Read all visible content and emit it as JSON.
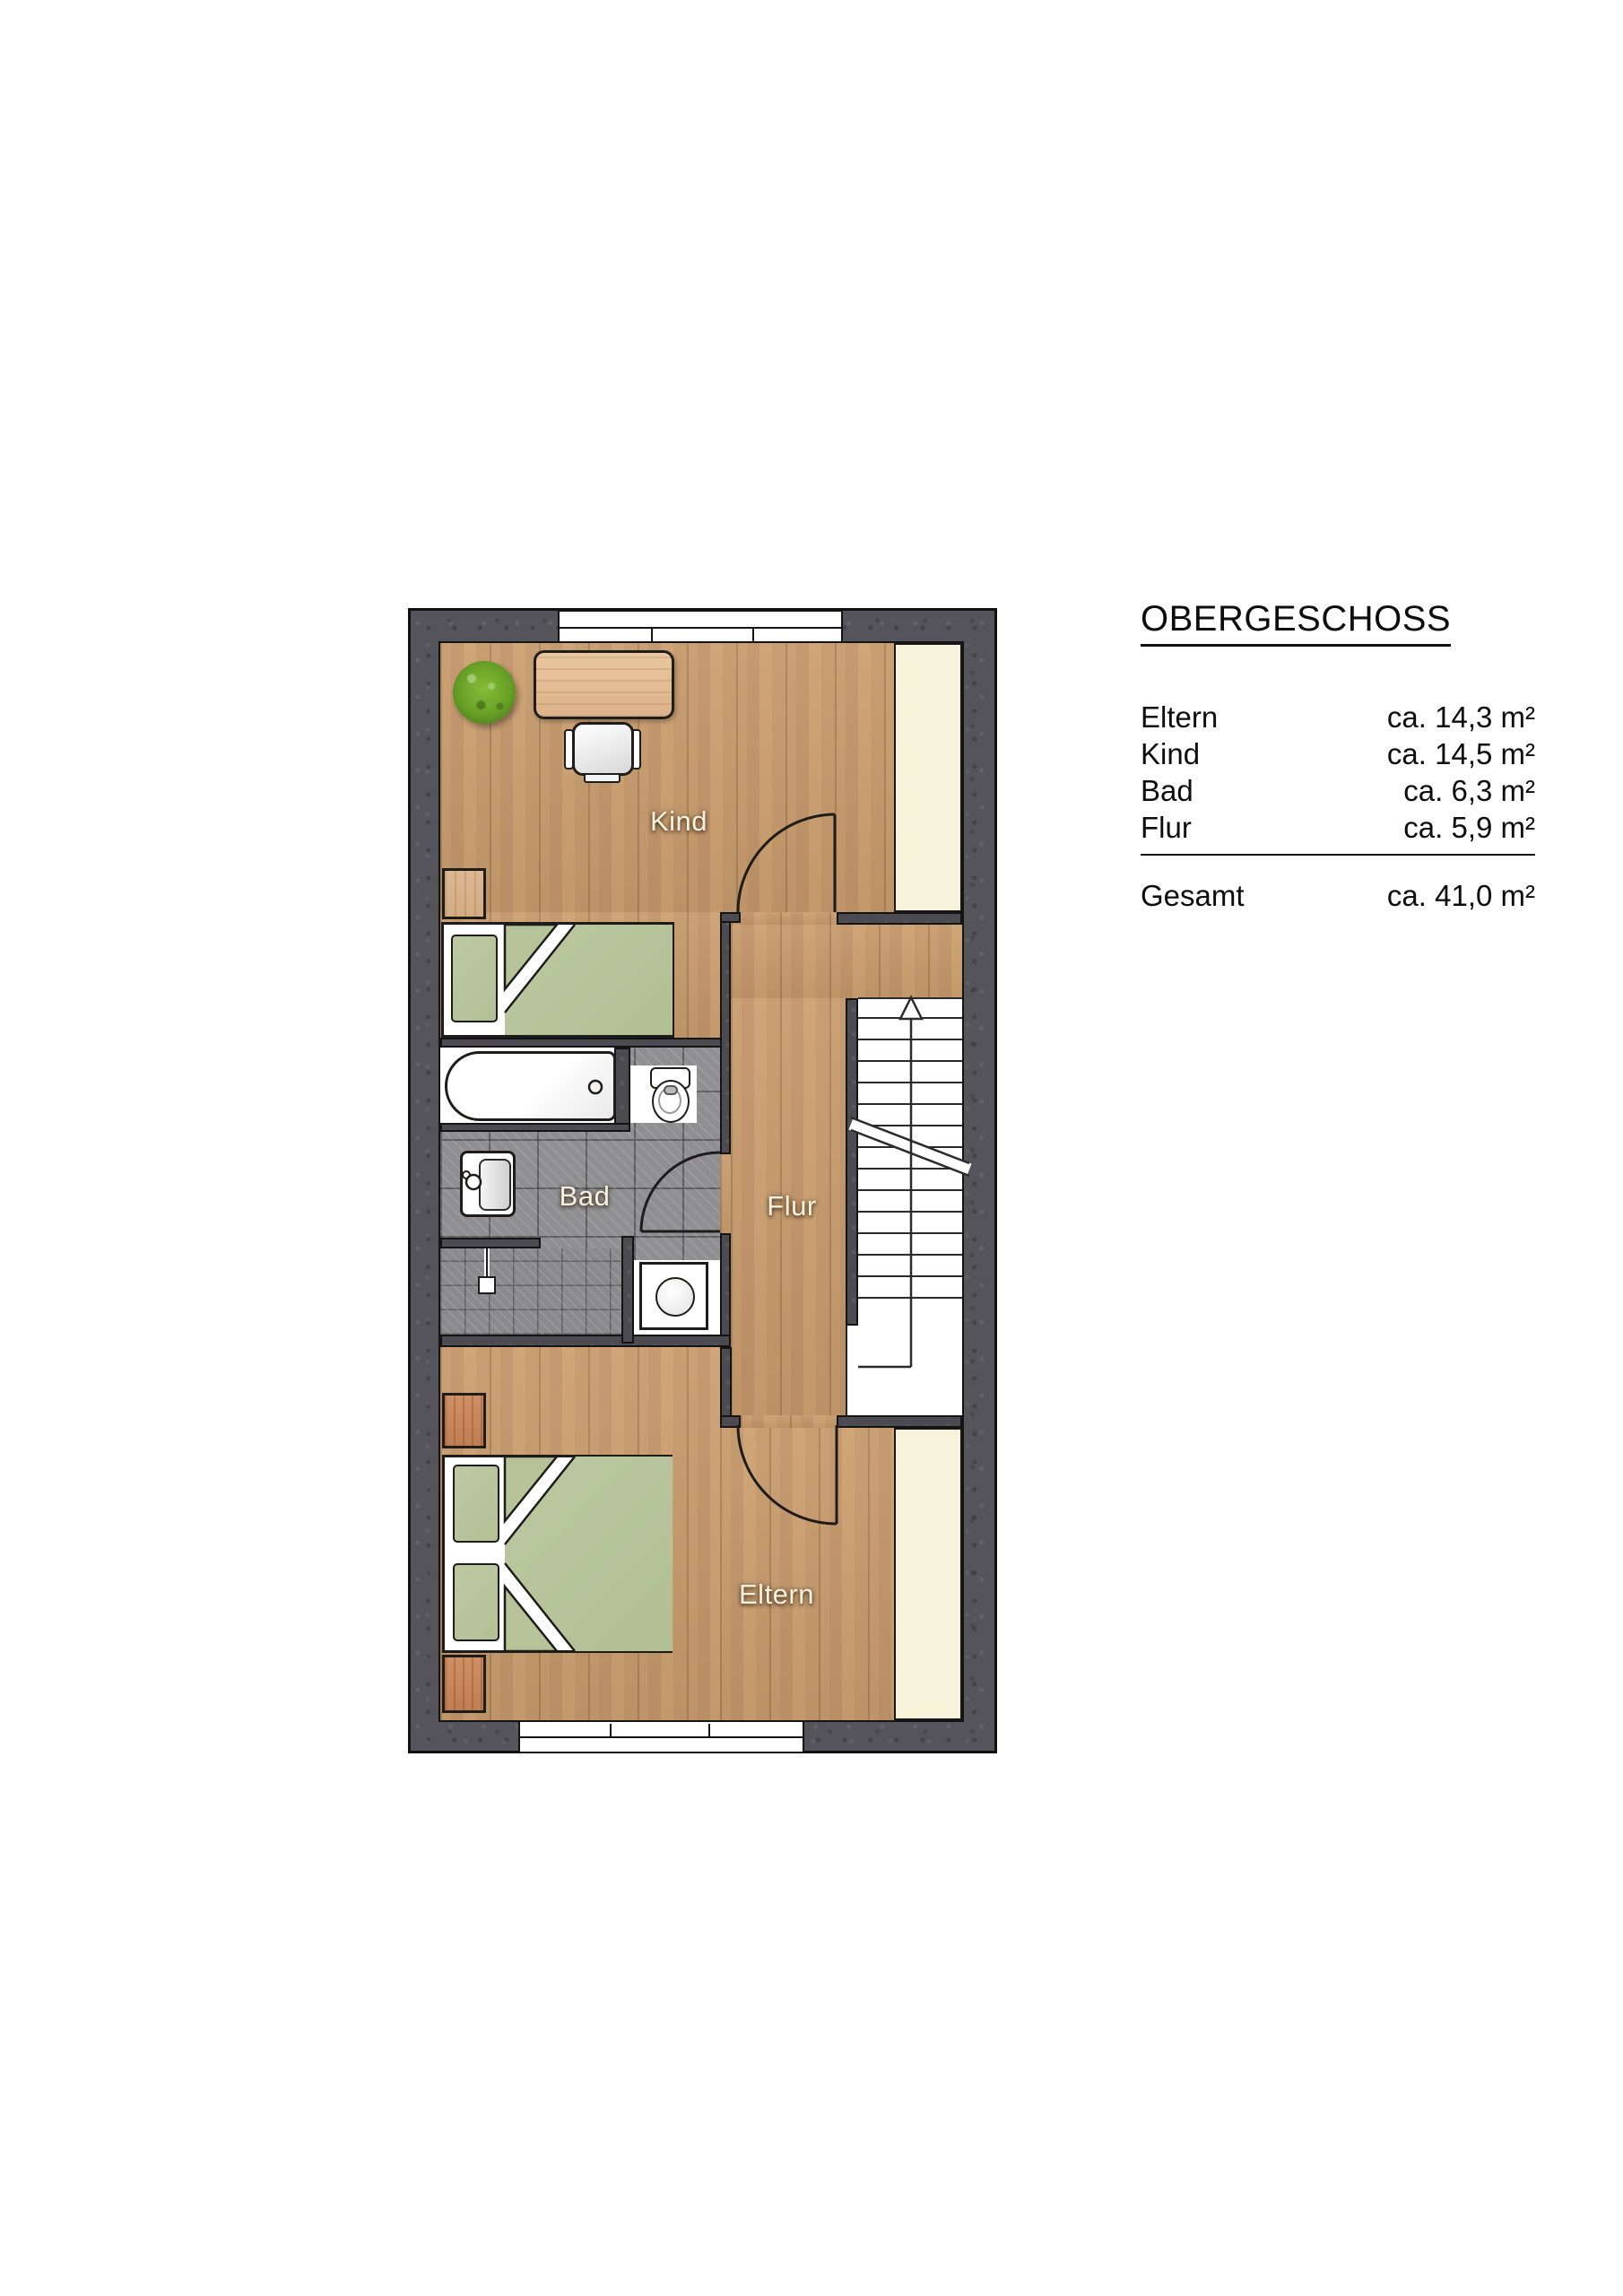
{
  "legend": {
    "title": "OBERGESCHOSS",
    "rows": [
      {
        "label": "Eltern",
        "area": "ca. 14,3 m²"
      },
      {
        "label": "Kind",
        "area": "ca. 14,5 m²"
      },
      {
        "label": "Bad",
        "area": "ca. 6,3 m²"
      },
      {
        "label": "Flur",
        "area": "ca. 5,9 m²"
      }
    ],
    "total": {
      "label": "Gesamt",
      "area": "ca. 41,0 m²"
    }
  },
  "rooms": {
    "kind": {
      "label": "Kind"
    },
    "bad": {
      "label": "Bad"
    },
    "flur": {
      "label": "Flur"
    },
    "eltern": {
      "label": "Eltern"
    }
  },
  "stairs": {
    "icon": "up-arrow"
  },
  "colors": {
    "wall": "#55545a",
    "wood": "#c89c6d",
    "tile": "#8f8f92",
    "cream": "#f8f4dc",
    "green": "#b9c69c",
    "outline": "#1c1c1c",
    "desk-wood": "#e3bf9a",
    "nightstand-wood": "#c9895c",
    "plant-green": "#67a026"
  }
}
